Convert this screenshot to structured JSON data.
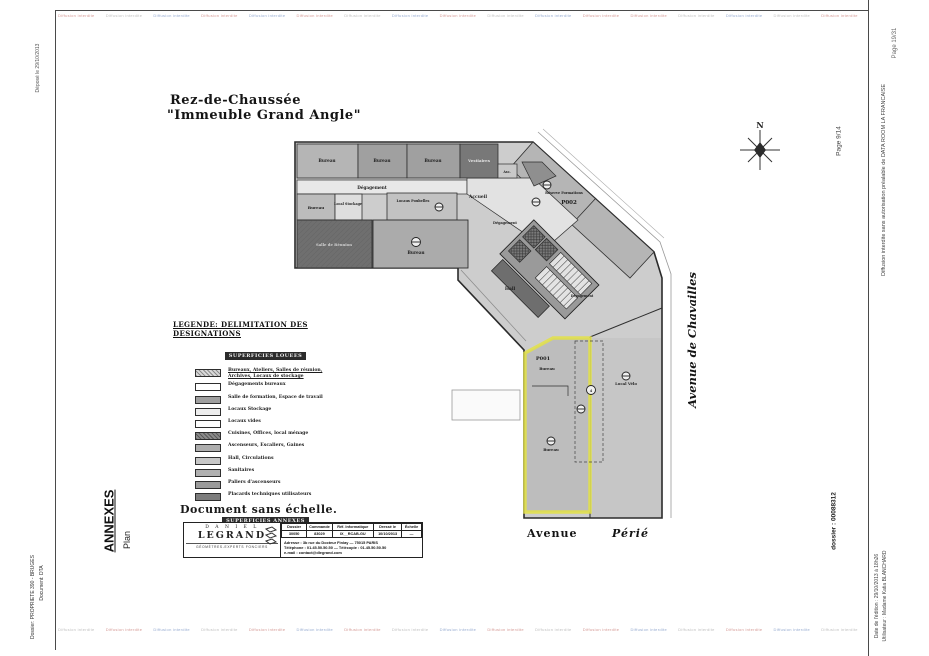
{
  "page": {
    "edge_texts": {
      "deposited": "Déposé le 29/10/2013",
      "dossier_left_line1": "Dossier: PROPRIETE 390 - BRUGES",
      "dossier_left_line2": "Document: DTA",
      "annexes": "ANNEXES",
      "plan": "Plan",
      "page_mid": "Page 9/14",
      "page_corner": "Page 19/31",
      "diffusion_notice": "Diffusion interdite sans autorisation préalable de DATA ROOM LA FRANCAISE",
      "dossier_right": "dossier : 00088312",
      "edition_date": "Date de l'édition : 29/10/2013 à 18h26",
      "user": "Utilisateur : Madame Katia BLANCHARD"
    },
    "watermark": {
      "text": "Diffusion interdite",
      "top_colors": [
        "#b04038",
        "#8a8a8a",
        "#3c63a8",
        "#b04038",
        "#3c63a8",
        "#b04038",
        "#8a8a8a",
        "#3c63a8",
        "#b04038",
        "#8a8a8a",
        "#3c63a8",
        "#b04038",
        "#b04038",
        "#8a8a8a",
        "#3c63a8",
        "#8a8a8a",
        "#b04038"
      ],
      "bottom_colors": [
        "#8a8a8a",
        "#b04038",
        "#3c63a8",
        "#8a8a8a",
        "#b04038",
        "#3c63a8",
        "#b04038",
        "#8a8a8a",
        "#3c63a8",
        "#b04038",
        "#8a8a8a",
        "#b04038",
        "#3c63a8",
        "#8a8a8a",
        "#b04038",
        "#3c63a8",
        "#8a8a8a"
      ]
    }
  },
  "drawing": {
    "title_line1": "Rez-de-Chaussée",
    "title_line2": "\"Immeuble Grand Angle\"",
    "north_label": "N",
    "highlight_color": "#e3e246",
    "streets": {
      "vertical": "Avenue  de  Chavailles",
      "bottom_left": "Avenue",
      "bottom_right": "Périé"
    },
    "zones": {
      "p001": "P001",
      "p002": "P002"
    },
    "markers": {
      "m4": "4"
    },
    "rooms": {
      "bureau": "Bureau",
      "vestiaires": "Vestiaires",
      "degagement": "Dégagement",
      "accueil": "Accueil",
      "hall": "Hall",
      "local_stockage": "Local Stockage",
      "locaux_poubelles": "Locaux Poubelles",
      "salle_reunion": "Salle de Réunion",
      "reserve_formations": "Réserve Formations",
      "local_velo": "Local Vélo",
      "asc": "Asc."
    }
  },
  "legend": {
    "title": "LEGENDE:  DELIMITATION  DES  DESIGNATIONS",
    "section1": "SUPERFICIES LOUEES",
    "items": [
      {
        "label_lines": [
          "Bureaux, Ateliers, Salles de réunion,",
          "Archives, Locaux de stockage"
        ],
        "fill": "#d9d9d9",
        "hatch": true,
        "emphasis": true
      },
      {
        "label_lines": [
          "Dégagements bureaux"
        ],
        "fill": "#ffffff",
        "hatch": false,
        "emphasis": false
      },
      {
        "label_lines": [
          "Salle de formation, Espace de travail"
        ],
        "fill": "#9f9f9f",
        "hatch": false,
        "emphasis": false
      },
      {
        "label_lines": [
          "Locaux Stockage"
        ],
        "fill": "#ededed",
        "hatch": false,
        "emphasis": false
      },
      {
        "label_lines": [
          "Locaux vides"
        ],
        "fill": "#ffffff",
        "hatch": false,
        "emphasis": false
      },
      {
        "label_lines": [
          "Cuisines, Offices, local ménage"
        ],
        "fill": "#8b8b8b",
        "hatch": true,
        "emphasis": false
      },
      {
        "label_lines": [
          "Ascenseurs, Escaliers, Gaines"
        ],
        "fill": "#adadad",
        "hatch": false,
        "emphasis": false
      },
      {
        "label_lines": [
          "Hall, Circulations"
        ],
        "fill": "#c6c6c6",
        "hatch": false,
        "emphasis": false
      },
      {
        "label_lines": [
          "Sanitaires"
        ],
        "fill": "#b0b0b0",
        "hatch": false,
        "emphasis": false
      },
      {
        "label_lines": [
          "Paliers d'ascenseurs"
        ],
        "fill": "#9a9a9a",
        "hatch": false,
        "emphasis": false
      },
      {
        "label_lines": [
          "Placards techniques utilisateurs"
        ],
        "fill": "#7c7c7c",
        "hatch": false,
        "emphasis": false
      }
    ],
    "section2": "SUPERFICIES ANNEXES",
    "annex_item": {
      "label_lines": [
        "Local technique ascenseurs"
      ],
      "fill": "#5a5a5a",
      "hatch": true,
      "emphasis": false
    }
  },
  "scale_note": "Document sans échelle.",
  "titleblock": {
    "firm_line1": "D A N I E L",
    "firm_line2": "LEGRAND",
    "firm_line3": "GÉOMÈTRES-EXPERTS FONCIERS",
    "cols": [
      "Dossier",
      "Commande",
      "Réf. Informatique",
      "Dressé le",
      "Échelle"
    ],
    "vals": [
      "30050",
      "83029",
      "IX__RCAB-GU",
      "10/10/2013",
      "—"
    ],
    "address": "Adresse : 3b rue du Docteur Finlay — 75015 PARIS",
    "phone": "Téléphone : 01.45.50.50.50   —   Télécopie : 01.45.50.50.50",
    "email": "e-mail : contact@dlegrand.com"
  }
}
